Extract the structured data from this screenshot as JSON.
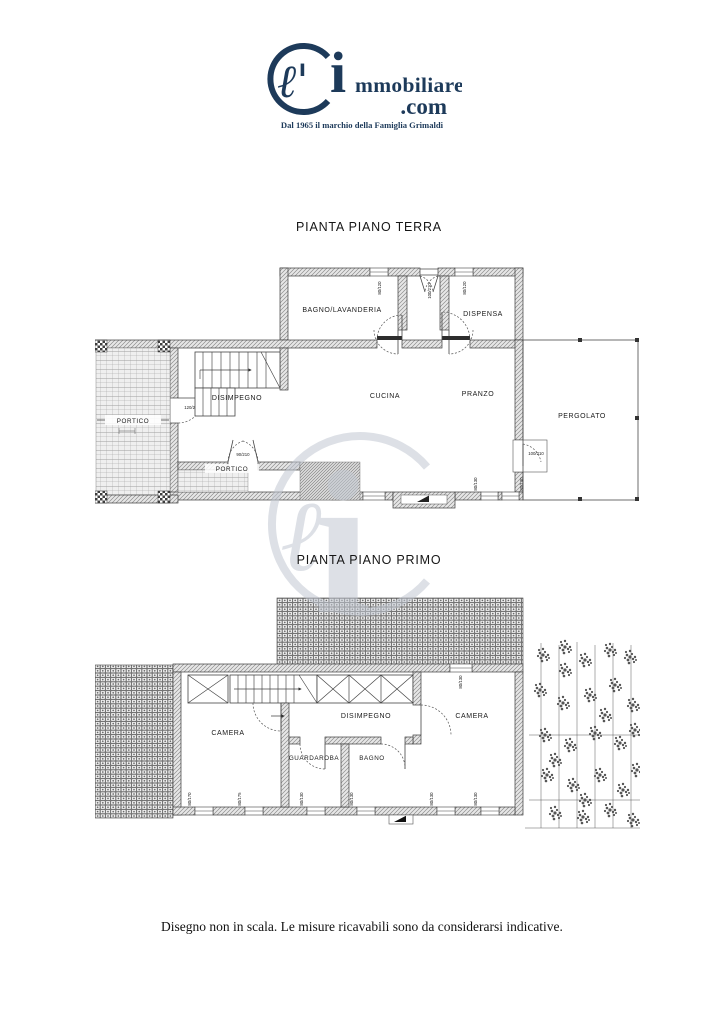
{
  "logo": {
    "script_l": "ℓ'",
    "big_i": "i",
    "brand": "mmobiliare",
    "tld": ".com",
    "tagline": "Dal 1965 il marchio della Famiglia Grimaldi"
  },
  "watermark": {
    "script_l": "ℓ",
    "big_i": "i"
  },
  "titles": {
    "ground_floor": "PIANTA PIANO TERRA",
    "first_floor": "PIANTA PIANO PRIMO"
  },
  "footer": {
    "disclaimer": "Disegno non in scala. Le misure ricavabili sono da considerarsi indicative."
  },
  "colors": {
    "brand_navy": "#1d3a5a",
    "plan_line": "#3c3c3c",
    "watermark_gray": "#c2c8d2"
  },
  "ground_floor": {
    "rooms": {
      "bagno_lavanderia": "BAGNO/LAVANDERIA",
      "dispensa": "DISPENSA",
      "disimpegno": "DISIMPEGNO",
      "cucina": "CUCINA",
      "pranzo": "PRANZO",
      "pergolato": "PERGOLATO",
      "portico_left": "PORTICO",
      "portico_bottom": "PORTICO"
    },
    "measures": [
      "80/120",
      "100/210",
      "80/120",
      "120/230",
      "90/210",
      "100/210",
      "60/170",
      "80/170",
      "80/130",
      "80/130"
    ]
  },
  "first_floor": {
    "rooms": {
      "camera_left": "CAMERA",
      "camera_right": "CAMERA",
      "disimpegno": "DISIMPEGNO",
      "guardaroba": "GUARDAROBA",
      "bagno": "BAGNO"
    },
    "measures": [
      "80/130",
      "80/170",
      "80/175",
      "80/130",
      "80/130",
      "80/130",
      "80/130"
    ]
  }
}
